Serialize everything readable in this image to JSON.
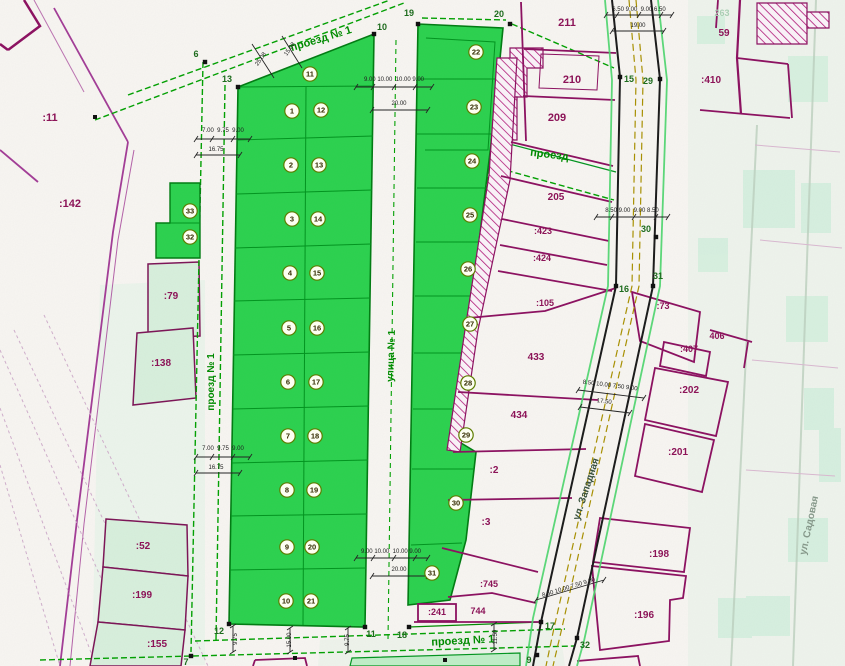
{
  "colors": {
    "subdivision_green": "#2bd14e",
    "plot_line_green": "#00941e",
    "survey_dash_green": "#00a000",
    "parcel_magenta": "#8c1458",
    "hatch_magenta": "#b01878",
    "street_centerline_olive": "#a89000",
    "dim_black": "#222222",
    "point_label_green": "#1d6b1d",
    "light_parcel_fill": "#d7efdc"
  },
  "street_labels": [
    {
      "label": "проезд № 1",
      "x": 322,
      "y": 42,
      "r": -17,
      "s": 11
    },
    {
      "label": "проезд № 1",
      "x": 214,
      "y": 382,
      "r": -90,
      "s": 10
    },
    {
      "label": "улица № 1",
      "x": 394,
      "y": 356,
      "r": -88,
      "s": 10
    },
    {
      "label": "проезд № 1",
      "x": 463,
      "y": 644,
      "r": -3,
      "s": 11
    },
    {
      "label": "проезд",
      "x": 549,
      "y": 158,
      "r": 7,
      "s": 11
    },
    {
      "label": "ул. Западная",
      "x": 589,
      "y": 490,
      "r": -72,
      "s": 10,
      "c": "#37503c"
    },
    {
      "label": "ул. Садовая",
      "x": 812,
      "y": 526,
      "r": -78,
      "s": 10,
      "c": "#86988a"
    }
  ],
  "plot_badges": [
    {
      "n": "1",
      "x": 292,
      "y": 111
    },
    {
      "n": "12",
      "x": 321,
      "y": 110
    },
    {
      "n": "2",
      "x": 291,
      "y": 165
    },
    {
      "n": "13",
      "x": 319,
      "y": 165
    },
    {
      "n": "3",
      "x": 292,
      "y": 219
    },
    {
      "n": "14",
      "x": 318,
      "y": 219
    },
    {
      "n": "4",
      "x": 290,
      "y": 273
    },
    {
      "n": "15",
      "x": 317,
      "y": 273
    },
    {
      "n": "5",
      "x": 289,
      "y": 328
    },
    {
      "n": "16",
      "x": 317,
      "y": 328
    },
    {
      "n": "6",
      "x": 288,
      "y": 382
    },
    {
      "n": "17",
      "x": 316,
      "y": 382
    },
    {
      "n": "7",
      "x": 288,
      "y": 436
    },
    {
      "n": "18",
      "x": 315,
      "y": 436
    },
    {
      "n": "8",
      "x": 287,
      "y": 490
    },
    {
      "n": "19",
      "x": 314,
      "y": 490
    },
    {
      "n": "9",
      "x": 287,
      "y": 547
    },
    {
      "n": "20",
      "x": 312,
      "y": 547
    },
    {
      "n": "10",
      "x": 286,
      "y": 601
    },
    {
      "n": "21",
      "x": 311,
      "y": 601
    },
    {
      "n": "11",
      "x": 310,
      "y": 74
    },
    {
      "n": "22",
      "x": 476,
      "y": 52
    },
    {
      "n": "23",
      "x": 474,
      "y": 107
    },
    {
      "n": "24",
      "x": 472,
      "y": 161
    },
    {
      "n": "25",
      "x": 470,
      "y": 215
    },
    {
      "n": "26",
      "x": 468,
      "y": 269
    },
    {
      "n": "27",
      "x": 470,
      "y": 324
    },
    {
      "n": "28",
      "x": 468,
      "y": 383
    },
    {
      "n": "29",
      "x": 466,
      "y": 435
    },
    {
      "n": "30",
      "x": 456,
      "y": 503
    },
    {
      "n": "31",
      "x": 432,
      "y": 573
    },
    {
      "n": "33",
      "x": 190,
      "y": 211
    },
    {
      "n": "32",
      "x": 190,
      "y": 237
    }
  ],
  "parcel_labels": [
    {
      "t": ":11",
      "x": 50,
      "y": 121,
      "s": 11
    },
    {
      "t": ":142",
      "x": 70,
      "y": 207,
      "s": 11
    },
    {
      "t": ":79",
      "x": 171,
      "y": 299,
      "s": 10
    },
    {
      "t": ":138",
      "x": 161,
      "y": 366,
      "s": 10
    },
    {
      "t": ":52",
      "x": 143,
      "y": 549,
      "s": 10
    },
    {
      "t": ":199",
      "x": 142,
      "y": 598,
      "s": 10
    },
    {
      "t": ":155",
      "x": 157,
      "y": 647,
      "s": 10
    },
    {
      "t": "211",
      "x": 567,
      "y": 26,
      "s": 11
    },
    {
      "t": "210",
      "x": 572,
      "y": 83,
      "s": 11
    },
    {
      "t": "209",
      "x": 557,
      "y": 121,
      "s": 11
    },
    {
      "t": "205",
      "x": 556,
      "y": 200,
      "s": 10
    },
    {
      "t": ":423",
      "x": 543,
      "y": 234,
      "s": 9
    },
    {
      "t": ":424",
      "x": 542,
      "y": 261,
      "s": 9
    },
    {
      "t": ":105",
      "x": 545,
      "y": 306,
      "s": 9
    },
    {
      "t": "433",
      "x": 536,
      "y": 360,
      "s": 10
    },
    {
      "t": "434",
      "x": 519,
      "y": 418,
      "s": 10
    },
    {
      "t": ":2",
      "x": 494,
      "y": 473,
      "s": 10
    },
    {
      "t": ":3",
      "x": 486,
      "y": 525,
      "s": 10
    },
    {
      "t": ":745",
      "x": 489,
      "y": 587,
      "s": 9
    },
    {
      "t": "744",
      "x": 478,
      "y": 614,
      "s": 9
    },
    {
      "t": ":241",
      "x": 437,
      "y": 615,
      "s": 9
    },
    {
      "t": "59",
      "x": 724,
      "y": 36,
      "s": 10
    },
    {
      "t": ":410",
      "x": 711,
      "y": 83,
      "s": 10
    },
    {
      "t": ":73",
      "x": 663,
      "y": 309,
      "s": 9
    },
    {
      "t": ":407",
      "x": 689,
      "y": 352,
      "s": 9
    },
    {
      "t": "406",
      "x": 717,
      "y": 339,
      "s": 9
    },
    {
      "t": ":202",
      "x": 689,
      "y": 393,
      "s": 10
    },
    {
      "t": ":201",
      "x": 678,
      "y": 455,
      "s": 10
    },
    {
      "t": ":198",
      "x": 659,
      "y": 557,
      "s": 10
    },
    {
      "t": ":196",
      "x": 644,
      "y": 618,
      "s": 10
    },
    {
      "t": "263",
      "x": 722,
      "y": 16,
      "s": 9,
      "c": "#aacfb4"
    }
  ],
  "survey_points": [
    {
      "label": "6",
      "x": 205,
      "y": 62,
      "lx": 196,
      "ly": 57
    },
    {
      "label": "13",
      "x": 238,
      "y": 87,
      "lx": 227,
      "ly": 82
    },
    {
      "label": "10",
      "x": 374,
      "y": 34,
      "lx": 382,
      "ly": 30
    },
    {
      "label": "19",
      "x": 418,
      "y": 24,
      "lx": 409,
      "ly": 16
    },
    {
      "label": "20",
      "x": 510,
      "y": 24,
      "lx": 499,
      "ly": 17
    },
    {
      "label": "15",
      "x": 620,
      "y": 77,
      "lx": 629,
      "ly": 82
    },
    {
      "label": "29",
      "x": 660,
      "y": 79,
      "lx": 648,
      "ly": 84
    },
    {
      "label": "30",
      "x": 656,
      "y": 237,
      "lx": 646,
      "ly": 232
    },
    {
      "label": "16",
      "x": 616,
      "y": 286,
      "lx": 624,
      "ly": 292
    },
    {
      "label": "31",
      "x": 653,
      "y": 286,
      "lx": 658,
      "ly": 279
    },
    {
      "label": "12",
      "x": 229,
      "y": 624,
      "lx": 219,
      "ly": 634
    },
    {
      "label": "11",
      "x": 365,
      "y": 627,
      "lx": 371,
      "ly": 637
    },
    {
      "label": "18",
      "x": 409,
      "y": 627,
      "lx": 402,
      "ly": 638
    },
    {
      "label": "17",
      "x": 541,
      "y": 622,
      "lx": 550,
      "ly": 629
    },
    {
      "label": "32",
      "x": 577,
      "y": 638,
      "lx": 585,
      "ly": 648
    },
    {
      "label": "9",
      "x": 537,
      "y": 655,
      "lx": 529,
      "ly": 663
    },
    {
      "label": "7",
      "x": 191,
      "y": 656,
      "lx": 186,
      "ly": 665
    }
  ],
  "junction_dots": [
    {
      "x": 95,
      "y": 117
    },
    {
      "x": 295,
      "y": 658
    },
    {
      "x": 445,
      "y": 660
    }
  ],
  "dimension_labels": [
    {
      "text": "7.00  9.75  9.00",
      "x": 223,
      "y": 132,
      "r": 0
    },
    {
      "text": "16.75",
      "x": 216,
      "y": 151,
      "r": 0
    },
    {
      "text": "7.00  9.75  9.00",
      "x": 223,
      "y": 450,
      "r": 0
    },
    {
      "text": "16.75",
      "x": 216,
      "y": 469,
      "r": 0
    },
    {
      "text": "9.00 10.00  10.00 9.00",
      "x": 394,
      "y": 81,
      "r": 0
    },
    {
      "text": "20.00",
      "x": 399,
      "y": 105,
      "r": 0
    },
    {
      "text": "6.50 9.00  9.00 6.50",
      "x": 639,
      "y": 11,
      "r": 0
    },
    {
      "text": "19.00",
      "x": 638,
      "y": 27,
      "r": 0
    },
    {
      "text": "8.50 9.00  9.00 8.50",
      "x": 632,
      "y": 212,
      "r": 0
    },
    {
      "text": "8.50 10.00 7.50 9.00",
      "x": 610,
      "y": 387,
      "r": 7
    },
    {
      "text": "17.50",
      "x": 604,
      "y": 403,
      "r": 7
    },
    {
      "text": "8.50 10.00 7.50 9.00",
      "x": 569,
      "y": 589,
      "r": -17
    },
    {
      "text": "9.00 10.00  10.00 9.00",
      "x": 391,
      "y": 553,
      "r": 0
    },
    {
      "text": "20.00",
      "x": 399,
      "y": 571,
      "r": 0
    },
    {
      "text": "9.75",
      "x": 237,
      "y": 639,
      "r": -90
    },
    {
      "text": "15.00",
      "x": 291,
      "y": 640,
      "r": -90
    },
    {
      "text": "9.75",
      "x": 349,
      "y": 640,
      "r": -90
    },
    {
      "text": "11.50",
      "x": 497,
      "y": 637,
      "r": -90
    },
    {
      "text": "25.08",
      "x": 262,
      "y": 60,
      "r": -55
    },
    {
      "text": "15.08",
      "x": 291,
      "y": 50,
      "r": -55
    }
  ]
}
